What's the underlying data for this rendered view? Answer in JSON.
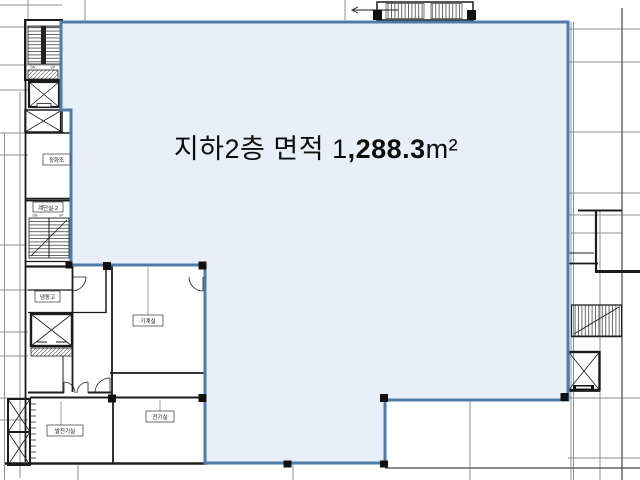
{
  "area_label": {
    "prefix": "지하2층 면적 1",
    "bold": ",288.3",
    "suffix": "m²"
  },
  "highlight": {
    "fill": "#e9eff9",
    "border": "#4e7ba9"
  },
  "rooms": {
    "septic": "정화조",
    "stair2": "계단실-2",
    "freezer": "냉동고",
    "machine": "기계실",
    "generator": "발전기실",
    "electrical": "전기실"
  },
  "stairs": {
    "dn": "DN",
    "up": "UP"
  }
}
